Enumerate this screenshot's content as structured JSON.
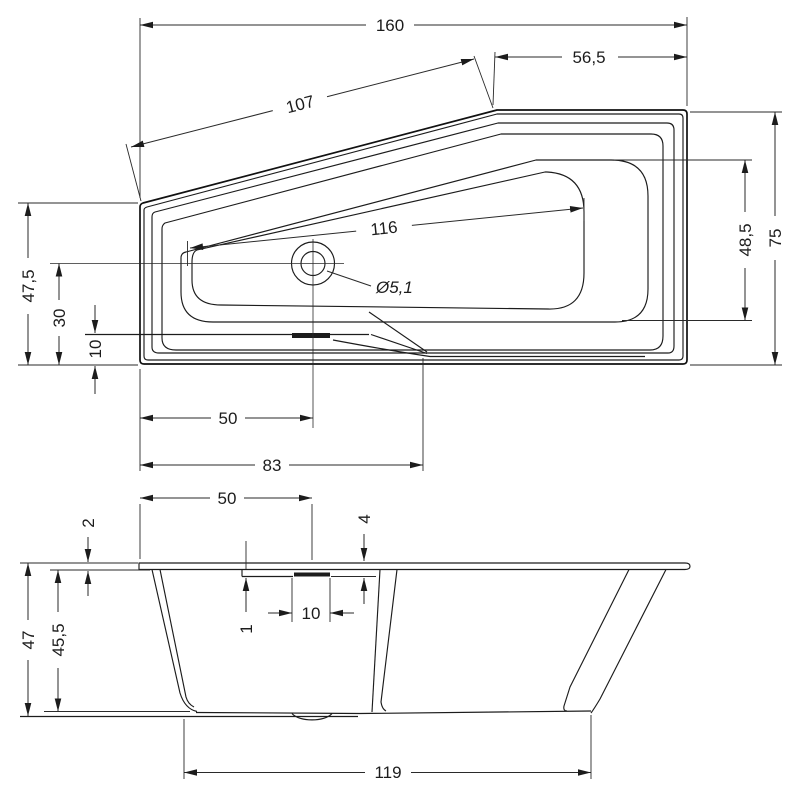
{
  "page": {
    "background": "#ffffff",
    "line_color": "#1c1c1c"
  },
  "top_view": {
    "dimensions": {
      "overall_length": "160",
      "head_section_length": "56,5",
      "slant_edge_length": "107",
      "basin_diagonal": "116",
      "drain_diameter": "Ø5,1",
      "overall_width": "75",
      "basin_width_right": "48,5",
      "left_height": "47,5",
      "drain_offset_bottom": "30",
      "step_offset_bottom": "10",
      "drain_offset_left": "50",
      "step_offset_left": "83"
    }
  },
  "front_view": {
    "dimensions": {
      "drain_offset_left": "50",
      "rim_thickness": "2",
      "recess_depth": "4",
      "recess_width": "10",
      "recess_step": "1",
      "overall_height": "47",
      "body_height": "45,5",
      "base_length": "119"
    }
  }
}
